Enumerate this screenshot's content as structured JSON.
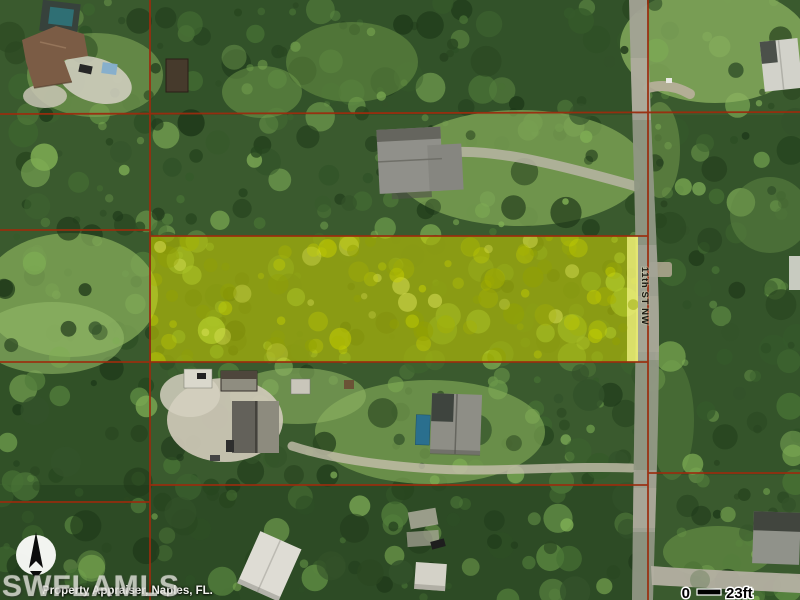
{
  "map": {
    "street_label": "11th ST NW",
    "scale_bar": {
      "start_label": "0",
      "end_label": "23ft"
    },
    "watermark": "SWFLAMLS",
    "attribution": "Property Appraiser, Naples, FL.",
    "compass": "north-arrow",
    "colors": {
      "parcel_highlight": "#D8DC00",
      "highlight_edge": "#EEF07E",
      "parcel_line": "#9B2C0E",
      "road": "#A3A396"
    }
  }
}
